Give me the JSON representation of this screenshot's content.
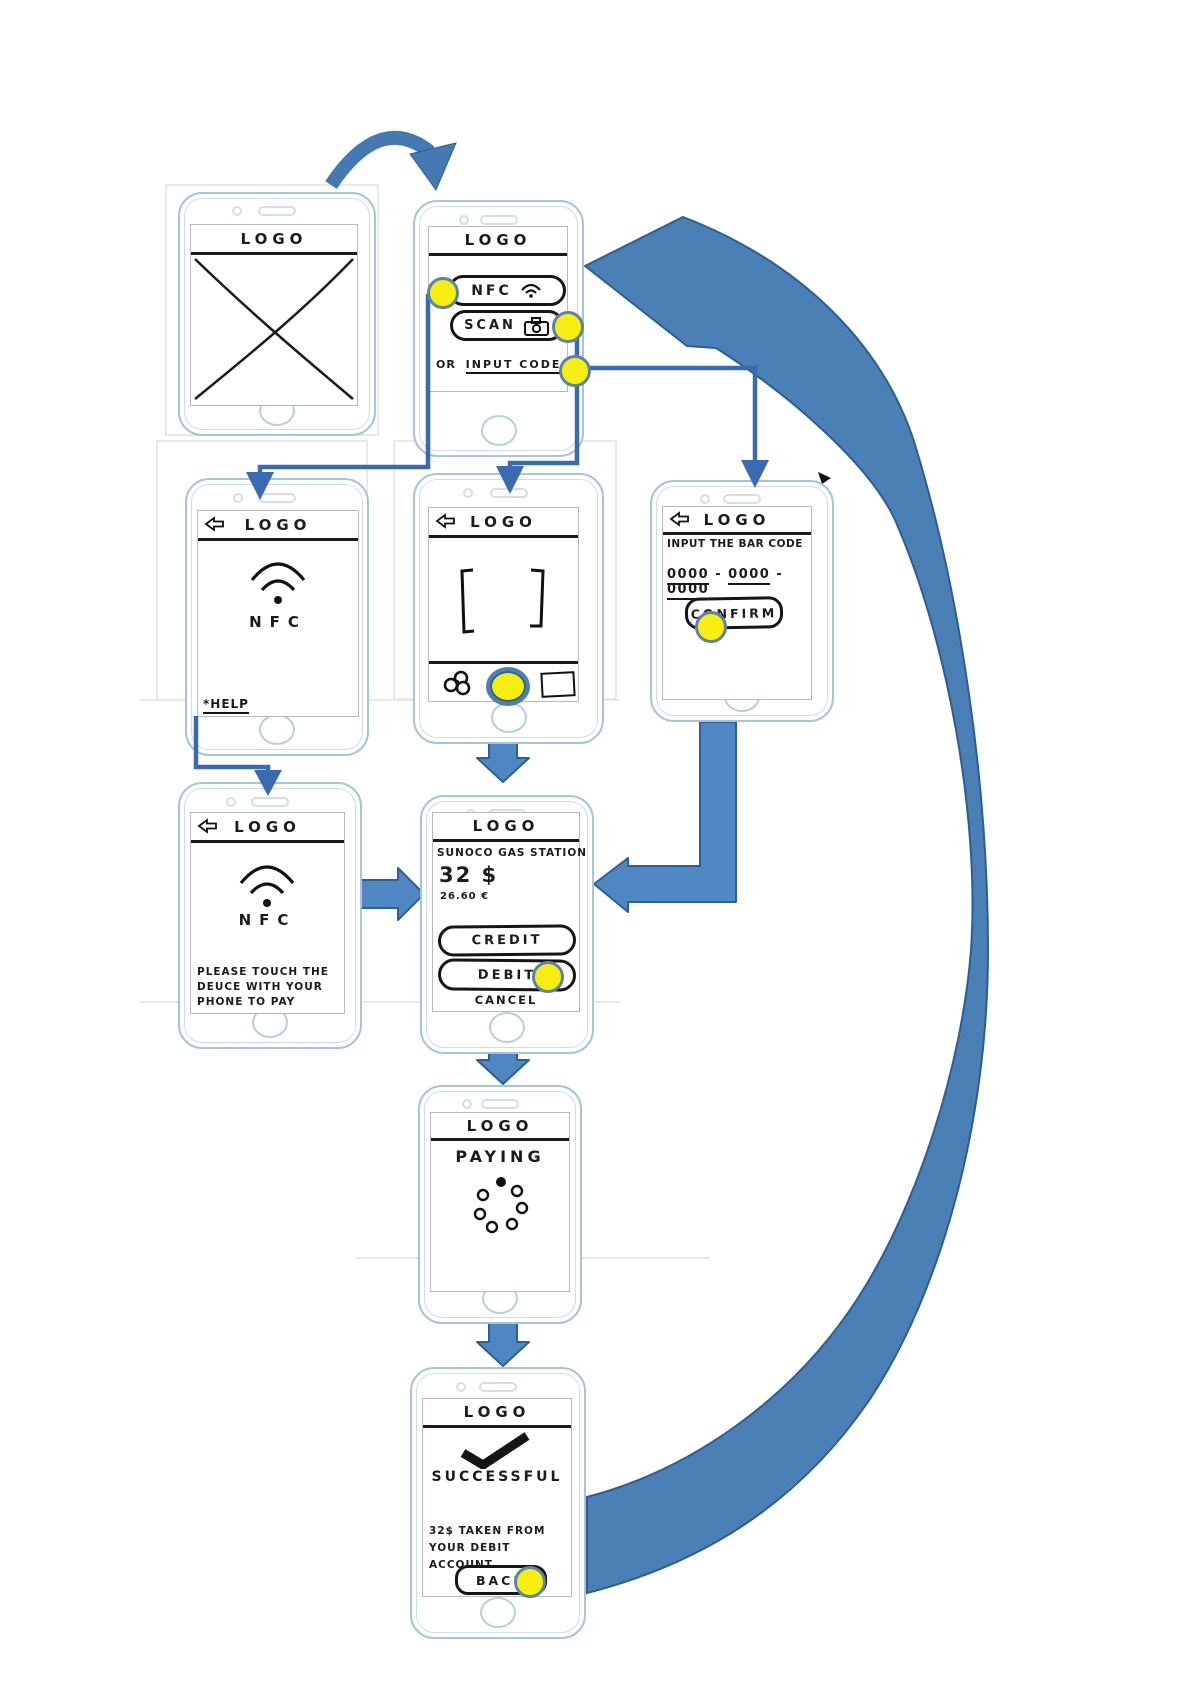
{
  "colors": {
    "flow_arrow_blue": "#4a80b6",
    "connector_blue": "#3a6bb2",
    "block_arrow_blue": "#4e87c2",
    "tap_highlight_yellow": "#f6ee10",
    "sketch_ink": "#1b1b1b",
    "phone_outline_blue": "#a6c4da"
  },
  "screens": {
    "splash": {
      "logo": "LOGO"
    },
    "home": {
      "logo": "LOGO",
      "nfc_button": "NFC",
      "scan_button": "SCAN",
      "or_label": "OR",
      "input_code_link": "INPUT CODE"
    },
    "nfc_detect": {
      "logo": "LOGO",
      "nfc_label": "NFC",
      "help_link": "*HELP"
    },
    "scan": {
      "logo": "LOGO"
    },
    "input_code": {
      "logo": "LOGO",
      "instruction": "INPUT THE BAR CODE",
      "code_groups": [
        "0000",
        "0000",
        "0000"
      ],
      "separator": "-",
      "confirm_button": "CONFIRM"
    },
    "nfc_pay": {
      "logo": "LOGO",
      "nfc_label": "NFC",
      "instruction_lines": [
        "PLEASE TOUCH THE",
        "DEUCE WITH YOUR",
        "PHONE TO PAY"
      ]
    },
    "payment": {
      "logo": "LOGO",
      "merchant": "SUNOCO GAS STATION",
      "amount_usd": "32 $",
      "amount_eur": "26.60 €",
      "credit_button": "CREDIT",
      "debit_button": "DEBIT",
      "cancel_button": "CANCEL"
    },
    "paying": {
      "logo": "LOGO",
      "status": "PAYING"
    },
    "success": {
      "logo": "LOGO",
      "status": "SUCCESSFUL",
      "detail_lines": [
        "32$ TAKEN FROM",
        "YOUR DEBIT ACCOUNT"
      ],
      "back_button": "BACK"
    }
  }
}
